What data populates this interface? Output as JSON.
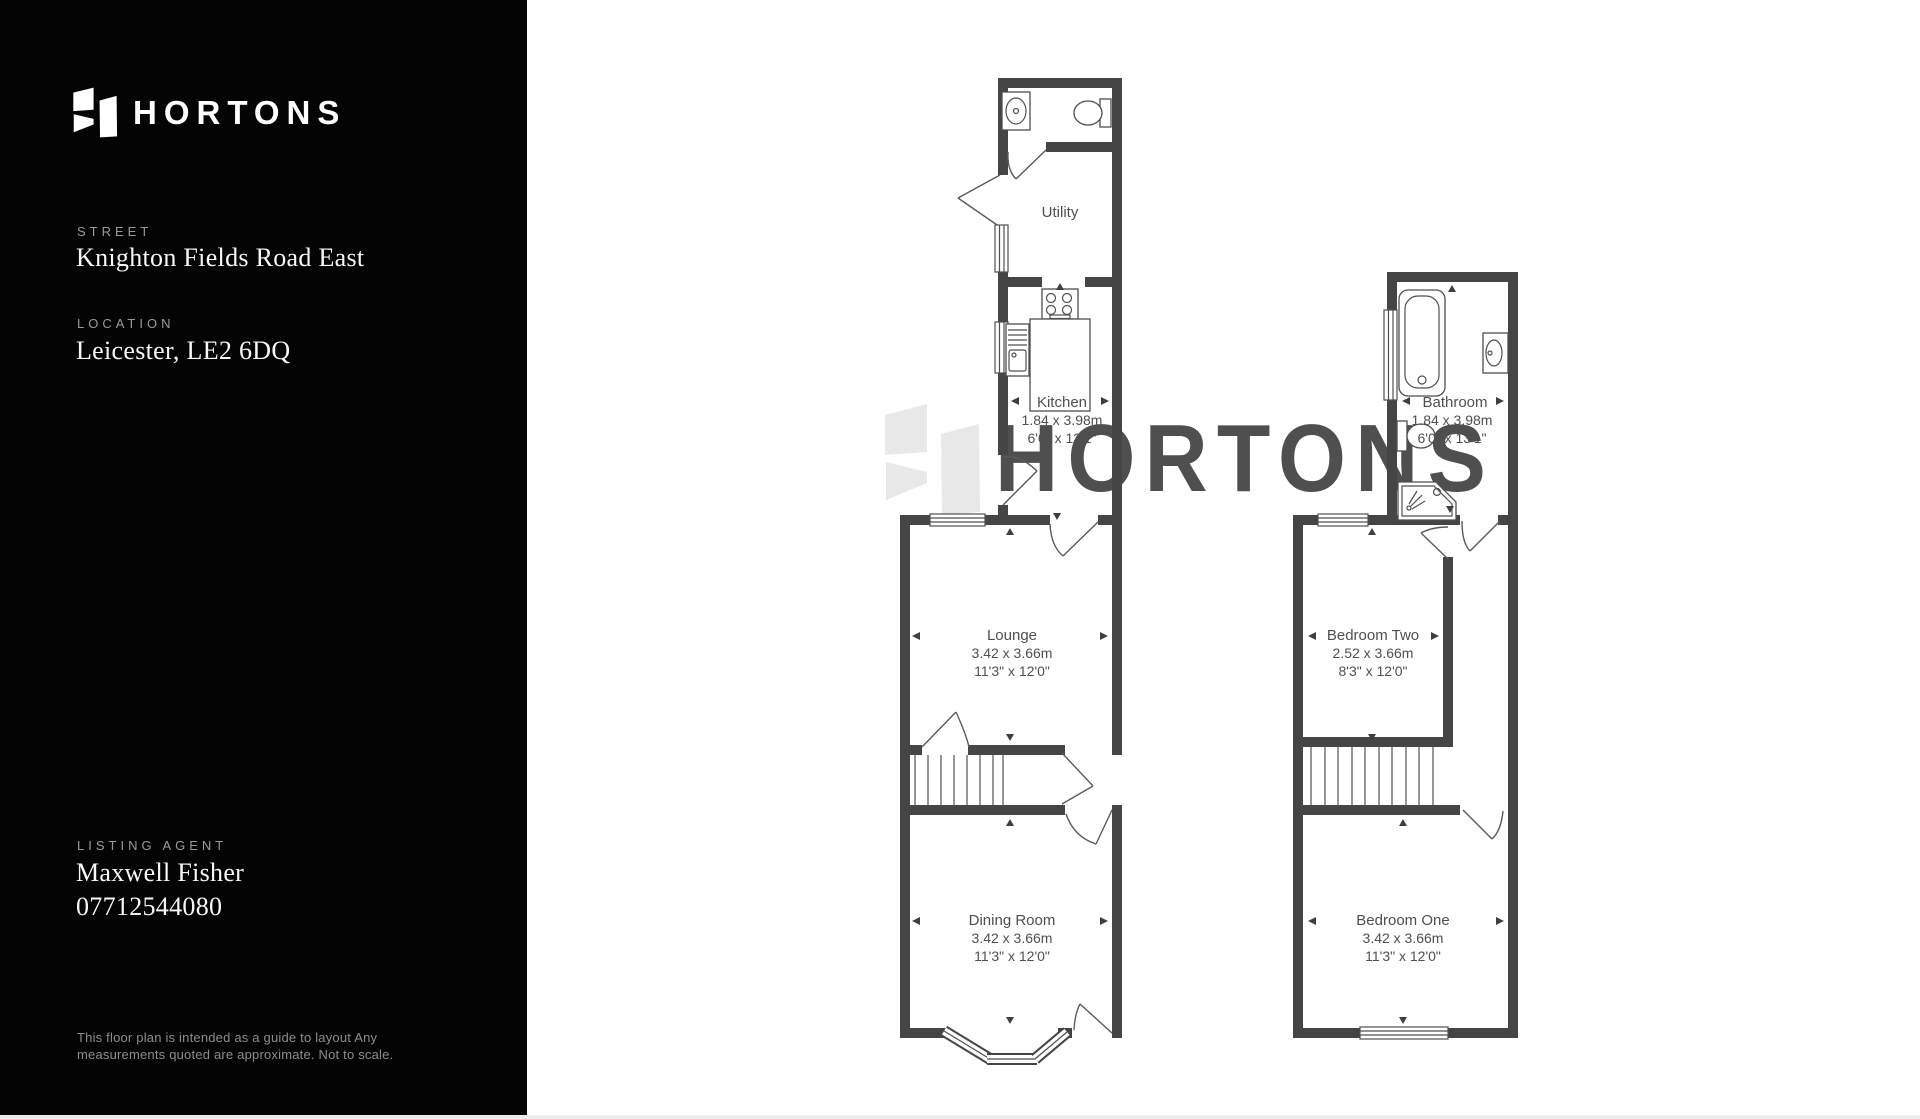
{
  "brand": {
    "name": "HORTONS"
  },
  "sidebar": {
    "street": {
      "label": "STREET",
      "value": "Knighton Fields Road East"
    },
    "location": {
      "label": "LOCATION",
      "value": "Leicester, LE2 6DQ"
    },
    "agent": {
      "label": "LISTING AGENT",
      "name": "Maxwell Fisher",
      "phone": "07712544080"
    },
    "disclaimer_line1": "This floor plan is intended  as a guide to layout Any",
    "disclaimer_line2": "measurements quoted are approximate. Not to scale."
  },
  "watermark": {
    "text": "HORTONS"
  },
  "floorplan": {
    "ground": {
      "utility": {
        "name": "Utility"
      },
      "kitchen": {
        "name": "Kitchen",
        "metric": "1.84 x 3.98m",
        "imperial": "6'0\" x 13'1\""
      },
      "lounge": {
        "name": "Lounge",
        "metric": "3.42 x 3.66m",
        "imperial": "11'3\" x 12'0\""
      },
      "dining": {
        "name": "Dining Room",
        "metric": "3.42 x 3.66m",
        "imperial": "11'3\" x 12'0\""
      }
    },
    "first": {
      "bathroom": {
        "name": "Bathroom",
        "metric": "1.84 x 3.98m",
        "imperial": "6'0\" x 13'1\""
      },
      "bedroom_two": {
        "name": "Bedroom Two",
        "metric": "2.52 x 3.66m",
        "imperial": "8'3\" x 12'0\""
      },
      "bedroom_one": {
        "name": "Bedroom One",
        "metric": "3.42 x 3.66m",
        "imperial": "11'3\" x 12'0\""
      }
    }
  },
  "colors": {
    "wall": "#454545",
    "label": "#4f4f4f",
    "watermark": "#e8e8e8",
    "sidebar_bg": "#040404",
    "muted_label": "#9a9a9a",
    "disclaimer": "#8d8d8d"
  }
}
